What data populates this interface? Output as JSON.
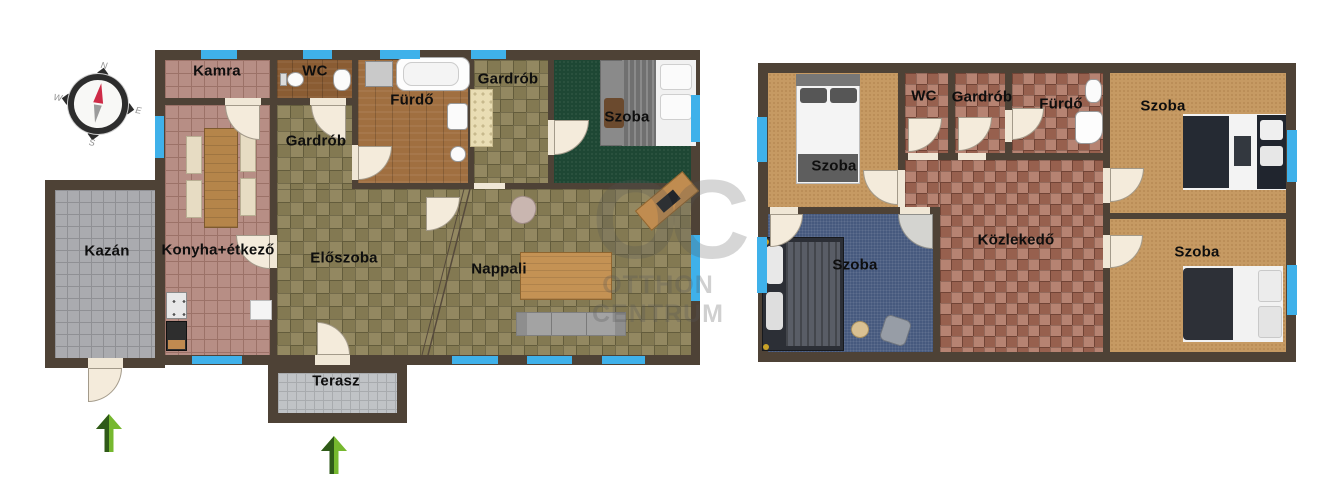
{
  "colors": {
    "wall": "#4e4236",
    "window_blue": "#3fb1ea",
    "arrow_green_light": "#76b82f",
    "arrow_green_dark": "#2f5a18",
    "watermark_gray": "#555555"
  },
  "compass": {
    "north": "N",
    "east": "E",
    "south": "S",
    "west": "W"
  },
  "watermark": {
    "monogram": "OC",
    "line1": "OTTHON",
    "line2": "CENTRUM"
  },
  "floor1": {
    "rooms": [
      {
        "label": "Kamra"
      },
      {
        "label": "WC"
      },
      {
        "label": "Fürdő"
      },
      {
        "label": "Gardrób"
      },
      {
        "label": "Szoba"
      },
      {
        "label": "Gardrób"
      },
      {
        "label": "Konyha+étkező"
      },
      {
        "label": "Előszoba"
      },
      {
        "label": "Nappali"
      },
      {
        "label": "Kazán"
      },
      {
        "label": "Terasz"
      }
    ]
  },
  "floor2": {
    "rooms": [
      {
        "label": "Szoba"
      },
      {
        "label": "WC"
      },
      {
        "label": "Gardrób"
      },
      {
        "label": "Fürdő"
      },
      {
        "label": "Szoba"
      },
      {
        "label": "Szoba"
      },
      {
        "label": "Közlekedő"
      },
      {
        "label": "Szoba"
      }
    ]
  }
}
